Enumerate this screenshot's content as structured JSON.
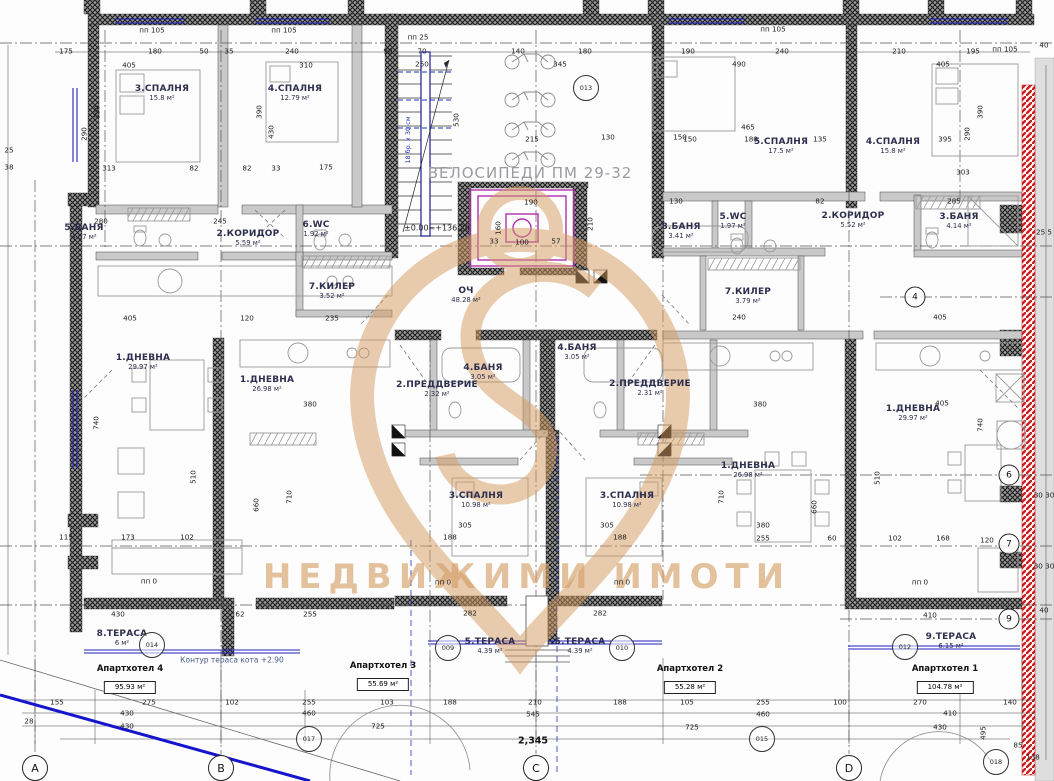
{
  "watermark": {
    "text": "НЕДВИЖИМИ ИМОТИ",
    "brand_color": "#d49a5f"
  },
  "annotations": {
    "bikes": "ВЕЛОСИПЕДИ ПМ 29-32",
    "level": "±0.00=+136.20",
    "terrace_contour": "Контур тераса кота +2.90",
    "total_width": "2,345",
    "stair_note": "18 бр. х 30 см"
  },
  "apartments": [
    {
      "name": "Апартхотел 4",
      "area": "95.93 м²",
      "x": 130,
      "y": 664
    },
    {
      "name": "Апартхотел 3",
      "area": "55.69 м²",
      "x": 383,
      "y": 661
    },
    {
      "name": "Апартхотел 2",
      "area": "55.28 м²",
      "x": 690,
      "y": 664
    },
    {
      "name": "Апартхотел 1",
      "area": "104.78 м²",
      "x": 945,
      "y": 664
    }
  ],
  "rooms": [
    {
      "n": "3.СПАЛНЯ",
      "a": "15.8 м²",
      "x": 162,
      "y": 93
    },
    {
      "n": "4.СПАЛНЯ",
      "a": "12.79 м²",
      "x": 295,
      "y": 93
    },
    {
      "n": "5.БАНЯ",
      "a": "4.07 м²",
      "x": 84,
      "y": 232
    },
    {
      "n": "2.КОРИДОР",
      "a": "5.59 м²",
      "x": 248,
      "y": 238
    },
    {
      "n": "6.WC",
      "a": "1.92 м²",
      "x": 316,
      "y": 229
    },
    {
      "n": "7.КИЛЕР",
      "a": "3.52 м²",
      "x": 332,
      "y": 291
    },
    {
      "n": "1.ДНЕВНА",
      "a": "29.97 м²",
      "x": 143,
      "y": 362
    },
    {
      "n": "8.ТЕРАСА",
      "a": "6 м²",
      "x": 122,
      "y": 638
    },
    {
      "n": "ОЧ",
      "a": "48.28 м²",
      "x": 466,
      "y": 295
    },
    {
      "n": "1.ДНЕВНА",
      "a": "26.98 м²",
      "x": 267,
      "y": 384
    },
    {
      "n": "2.ПРЕДДВЕРИЕ",
      "a": "2.32 м²",
      "x": 437,
      "y": 389
    },
    {
      "n": "4.БАНЯ",
      "a": "3.05 м²",
      "x": 483,
      "y": 372
    },
    {
      "n": "3.СПАЛНЯ",
      "a": "10.98 м²",
      "x": 476,
      "y": 500
    },
    {
      "n": "5.ТЕРАСА",
      "a": "4.39 м²",
      "x": 490,
      "y": 646
    },
    {
      "n": "4.БАНЯ",
      "a": "3.05 м²",
      "x": 577,
      "y": 352
    },
    {
      "n": "2.ПРЕДДВЕРИЕ",
      "a": "2.31 м²",
      "x": 650,
      "y": 388
    },
    {
      "n": "3.СПАЛНЯ",
      "a": "10.98 м²",
      "x": 627,
      "y": 500
    },
    {
      "n": "5.ТЕРАСА",
      "a": "4.39 м²",
      "x": 580,
      "y": 646
    },
    {
      "n": "1.ДНЕВНА",
      "a": "26.98 м²",
      "x": 748,
      "y": 470
    },
    {
      "n": "5.СПАЛНЯ",
      "a": "17.5 м²",
      "x": 781,
      "y": 146
    },
    {
      "n": "4.СПАЛНЯ",
      "a": "15.8 м²",
      "x": 893,
      "y": 146
    },
    {
      "n": "8.БАНЯ",
      "a": "3.41 м²",
      "x": 681,
      "y": 231
    },
    {
      "n": "5.WC",
      "a": "1.97 м²",
      "x": 733,
      "y": 221
    },
    {
      "n": "2.КОРИДОР",
      "a": "5.52 м²",
      "x": 853,
      "y": 220
    },
    {
      "n": "3.БАНЯ",
      "a": "4.14 м²",
      "x": 959,
      "y": 221
    },
    {
      "n": "7.КИЛЕР",
      "a": "3.79 м²",
      "x": 748,
      "y": 296
    },
    {
      "n": "1.ДНЕВНА",
      "a": "29.97 м²",
      "x": 913,
      "y": 413
    },
    {
      "n": "9.ТЕРАСА",
      "a": "6.15 м²",
      "x": 951,
      "y": 641
    }
  ],
  "refs": [
    {
      "t": "013",
      "x": 586,
      "y": 88
    },
    {
      "t": "014",
      "x": 152,
      "y": 645
    },
    {
      "t": "009",
      "x": 448,
      "y": 648
    },
    {
      "t": "010",
      "x": 622,
      "y": 648
    },
    {
      "t": "012",
      "x": 905,
      "y": 647
    },
    {
      "t": "015",
      "x": 762,
      "y": 739
    },
    {
      "t": "017",
      "x": 309,
      "y": 739
    },
    {
      "t": "018",
      "x": 996,
      "y": 762
    }
  ],
  "axis_letters": [
    {
      "t": "A",
      "x": 35,
      "y": 768
    },
    {
      "t": "B",
      "x": 221,
      "y": 768
    },
    {
      "t": "C",
      "x": 536,
      "y": 768
    },
    {
      "t": "D",
      "x": 849,
      "y": 768
    }
  ],
  "axis_numbers": [
    {
      "t": "4",
      "x": 915,
      "y": 297
    },
    {
      "t": "6",
      "x": 1009,
      "y": 475
    },
    {
      "t": "7",
      "x": 1009,
      "y": 544
    },
    {
      "t": "9",
      "x": 1009,
      "y": 619
    }
  ],
  "dims": [
    [
      "175",
      66,
      51
    ],
    [
      "180",
      155,
      51
    ],
    [
      "50",
      204,
      51
    ],
    [
      "35",
      229,
      51
    ],
    [
      "240",
      292,
      51
    ],
    [
      "90",
      388,
      51
    ],
    [
      "70",
      422,
      51
    ],
    [
      "140",
      518,
      51
    ],
    [
      "180",
      585,
      51
    ],
    [
      "190",
      688,
      51
    ],
    [
      "240",
      782,
      51
    ],
    [
      "210",
      899,
      51
    ],
    [
      "195",
      973,
      51
    ],
    [
      "405",
      129,
      65
    ],
    [
      "310",
      306,
      65
    ],
    [
      "250",
      422,
      64
    ],
    [
      "345",
      560,
      64
    ],
    [
      "490",
      739,
      64
    ],
    [
      "405",
      943,
      64
    ],
    [
      "пп 105",
      152,
      30
    ],
    [
      "пп 105",
      284,
      30
    ],
    [
      "пп 25",
      418,
      37
    ],
    [
      "пп 105",
      773,
      29
    ],
    [
      "пп 105",
      1005,
      49
    ],
    [
      "390",
      97,
      112,
      1
    ],
    [
      "290",
      84,
      134,
      1
    ],
    [
      "390",
      259,
      112,
      1
    ],
    [
      "430",
      271,
      132,
      1
    ],
    [
      "530",
      456,
      120,
      1
    ],
    [
      "390",
      980,
      112,
      1
    ],
    [
      "290",
      967,
      134,
      1
    ],
    [
      "160",
      498,
      228,
      1
    ],
    [
      "210",
      590,
      224,
      1
    ],
    [
      "465",
      748,
      127
    ],
    [
      "150",
      690,
      139
    ],
    [
      "180",
      751,
      139
    ],
    [
      "135",
      820,
      139
    ],
    [
      "395",
      945,
      139
    ],
    [
      "215",
      532,
      139
    ],
    [
      "130",
      608,
      137
    ],
    [
      "150",
      680,
      137
    ],
    [
      "313",
      109,
      168
    ],
    [
      "82",
      194,
      168
    ],
    [
      "82",
      247,
      168
    ],
    [
      "33",
      276,
      168
    ],
    [
      "175",
      326,
      167
    ],
    [
      "303",
      963,
      172
    ],
    [
      "190",
      531,
      202
    ],
    [
      "130",
      676,
      201
    ],
    [
      "82",
      820,
      201
    ],
    [
      "285",
      954,
      201
    ],
    [
      "280",
      101,
      221
    ],
    [
      "245",
      220,
      221
    ],
    [
      "33",
      494,
      241
    ],
    [
      "100",
      522,
      242
    ],
    [
      "57",
      556,
      241
    ],
    [
      "405",
      130,
      318
    ],
    [
      "235",
      332,
      318
    ],
    [
      "120",
      247,
      318
    ],
    [
      "240",
      739,
      317
    ],
    [
      "405",
      940,
      317
    ],
    [
      "380",
      310,
      404
    ],
    [
      "380",
      760,
      404
    ],
    [
      "405",
      942,
      403
    ],
    [
      "510",
      193,
      477,
      1
    ],
    [
      "510",
      877,
      478,
      1
    ],
    [
      "710",
      289,
      497,
      1
    ],
    [
      "710",
      721,
      497,
      1
    ],
    [
      "660",
      256,
      505,
      1
    ],
    [
      "660",
      814,
      507,
      1
    ],
    [
      "740",
      96,
      423,
      1
    ],
    [
      "740",
      980,
      425,
      1
    ],
    [
      "305",
      465,
      525
    ],
    [
      "305",
      607,
      525
    ],
    [
      "188",
      450,
      537
    ],
    [
      "188",
      620,
      537
    ],
    [
      "115",
      66,
      537
    ],
    [
      "173",
      128,
      537
    ],
    [
      "102",
      187,
      537
    ],
    [
      "380",
      763,
      525
    ],
    [
      "255",
      763,
      538
    ],
    [
      "60",
      832,
      538
    ],
    [
      "102",
      895,
      538
    ],
    [
      "168",
      943,
      538
    ],
    [
      "430",
      118,
      614
    ],
    [
      "62",
      240,
      614
    ],
    [
      "255",
      310,
      614
    ],
    [
      "282",
      470,
      613
    ],
    [
      "282",
      600,
      613
    ],
    [
      "410",
      930,
      615
    ],
    [
      "пп 0",
      149,
      581
    ],
    [
      "пп 0",
      443,
      582
    ],
    [
      "пп 0",
      622,
      582
    ],
    [
      "пп 0",
      920,
      582
    ],
    [
      "155",
      57,
      702
    ],
    [
      "275",
      149,
      702
    ],
    [
      "102",
      232,
      702
    ],
    [
      "255",
      309,
      702
    ],
    [
      "103",
      387,
      702
    ],
    [
      "188",
      450,
      702
    ],
    [
      "210",
      535,
      702
    ],
    [
      "188",
      620,
      702
    ],
    [
      "105",
      687,
      702
    ],
    [
      "255",
      763,
      702
    ],
    [
      "100",
      840,
      702
    ],
    [
      "270",
      920,
      702
    ],
    [
      "140",
      1010,
      702
    ],
    [
      "430",
      127,
      713
    ],
    [
      "460",
      309,
      713
    ],
    [
      "545",
      533,
      714
    ],
    [
      "460",
      763,
      714
    ],
    [
      "410",
      950,
      713
    ],
    [
      "28",
      29,
      721
    ],
    [
      "430",
      127,
      726
    ],
    [
      "725",
      378,
      726
    ],
    [
      "725",
      692,
      727
    ],
    [
      "430",
      940,
      727
    ],
    [
      "40",
      1044,
      45
    ],
    [
      "25 5",
      1044,
      232
    ],
    [
      "30 30",
      1044,
      495
    ],
    [
      "30 30",
      1044,
      566
    ],
    [
      "40",
      1044,
      610
    ],
    [
      "120",
      987,
      540
    ],
    [
      "495",
      983,
      733,
      1
    ],
    [
      "85",
      1018,
      745
    ],
    [
      "138",
      1033,
      757
    ],
    [
      "25",
      9,
      150
    ],
    [
      "38",
      9,
      167
    ]
  ]
}
